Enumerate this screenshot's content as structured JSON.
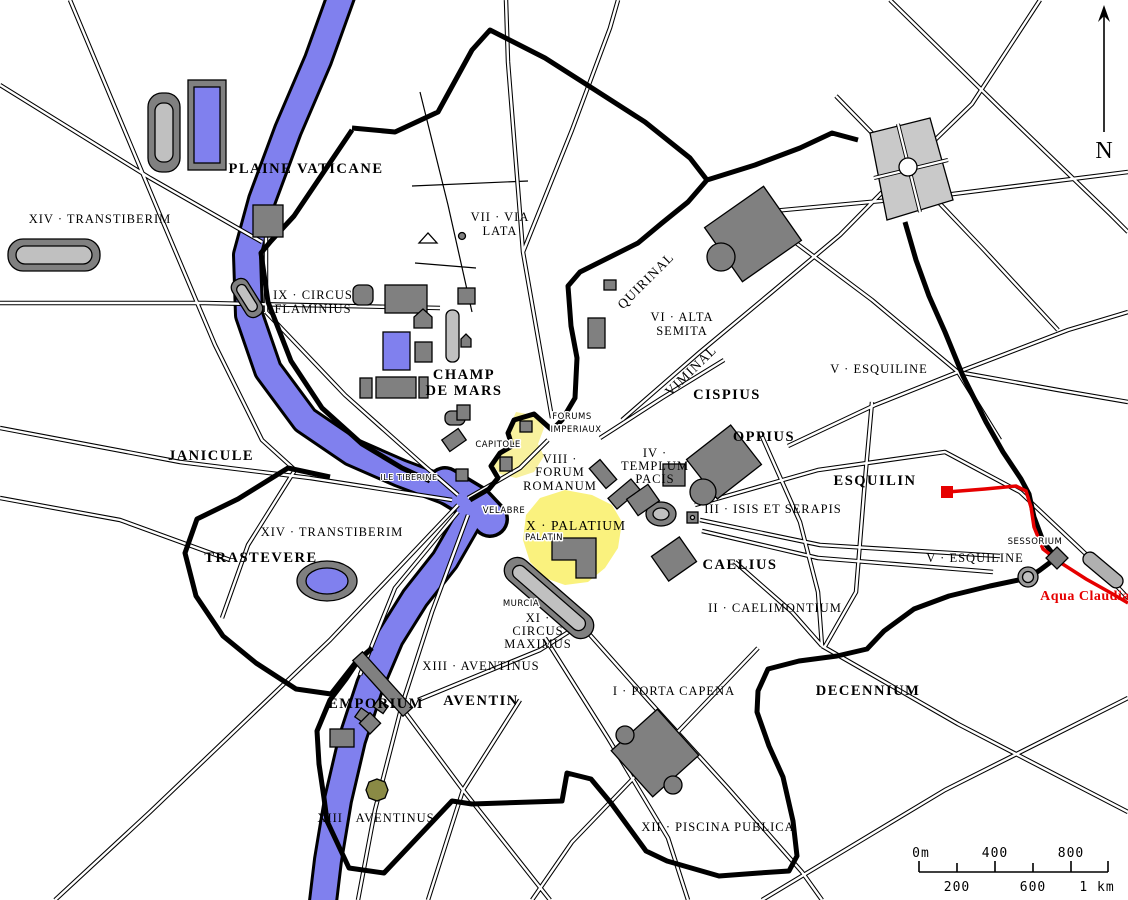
{
  "map_title": "Plan of ancient Rome with the fourteen Augustan regions",
  "colors": {
    "river_blue": "#8080ee",
    "building_gray": "#808080",
    "building_light_gray": "#c0c0c0",
    "highlight_yellow": "#f8f19e",
    "aqueduct_red": "#e60000",
    "wall_black": "#000000",
    "olive": "#8a8a45"
  },
  "labels": {
    "plaine_vaticane": "PLAINE VATICANE",
    "transtiberim_top": "XIV · TRANSTIBERIM",
    "circus_flaminius_l1": "IX · CIRCUS",
    "circus_flaminius_l2": "FLAMINIUS",
    "via_lata_l1": "VII · VIA",
    "via_lata_l2": "LATA",
    "champ_de_mars_l1": "CHAMP",
    "champ_de_mars_l2": "DE MARS",
    "quirinal": "QUIRINAL",
    "alta_semita_l1": "VI · ALTA",
    "alta_semita_l2": "SEMITA",
    "viminal": "VIMINAL",
    "cispius": "CISPIUS",
    "oppius": "OPPIUS",
    "esquiline_upper": "V · ESQUILINE",
    "esquilin": "ESQUILIN",
    "templum_pacis_l1": "IV ·",
    "templum_pacis_l2": "TEMPLUM",
    "templum_pacis_l3": "PACIS",
    "forums_imperiaux_l1": "FORUMS",
    "forums_imperiaux_l2": "IMPERIAUX",
    "capitole": "CAPITOLE",
    "forum_romanum_l1": "VIII ·",
    "forum_romanum_l2": "FORUM",
    "forum_romanum_l3": "ROMANUM",
    "velabre": "VELABRE",
    "palatium": "X · PALATIUM",
    "palatin": "PALATIN",
    "isis_et_serapis": "III · ISIS ET SERAPIS",
    "caelius": "CAELIUS",
    "caelimontium": "II · CAELIMONTIUM",
    "sessorium": "SESSORIUM",
    "esquiline_lower": "V · ESQUILINE",
    "aqua_claudia": "Aqua Claudia",
    "murcia": "MURCIA",
    "circus_maximus_l1": "XI ·",
    "circus_maximus_l2": "CIRCUS",
    "circus_maximus_l3": "MAXIMUS",
    "aventinus_upper": "XIII · AVENTINUS",
    "aventin": "AVENTIN",
    "emporium": "EMPORIUM",
    "porta_capena": "I · PORTA CAPENA",
    "decennium": "DECENNIUM",
    "aventinus_lower": "XIII · AVENTINUS",
    "piscina_publica": "XII · PISCINA PUBLICA",
    "janicule": "JANICULE",
    "ile_tiberine": "ILE TIBERINE",
    "transtiberim_lower": "XIV · TRANSTIBERIM",
    "trastevere": "TRASTEVERE"
  },
  "compass": {
    "north": "N"
  },
  "scale_bar": {
    "above": [
      "0m",
      "400",
      "800"
    ],
    "below": [
      "200",
      "600",
      "1 km"
    ]
  }
}
